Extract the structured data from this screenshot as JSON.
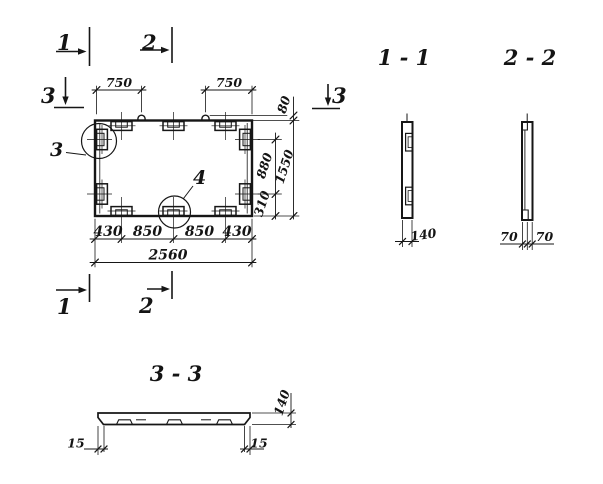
{
  "plan": {
    "markers": {
      "top_1": "1",
      "top_2": "2",
      "bottom_1": "1",
      "bottom_2": "2",
      "left_3": "3",
      "right_3": "3"
    },
    "details": {
      "circle_3": "3",
      "circle_4": "4"
    },
    "dims": {
      "top_left": "750",
      "top_right": "750",
      "loop_height": "80",
      "overall_height": "1550",
      "upper": "880",
      "lower": "310",
      "bottom_1": "430",
      "bottom_2": "850",
      "bottom_3": "850",
      "bottom_4": "430",
      "overall_width": "2560"
    }
  },
  "sections": {
    "s1": {
      "title": "1 - 1",
      "thickness": "140"
    },
    "s2": {
      "title": "2 - 2",
      "left": "70",
      "right": "70"
    },
    "s3": {
      "title": "3 - 3",
      "left_offset": "15",
      "right_offset": "15",
      "thickness": "140"
    }
  }
}
